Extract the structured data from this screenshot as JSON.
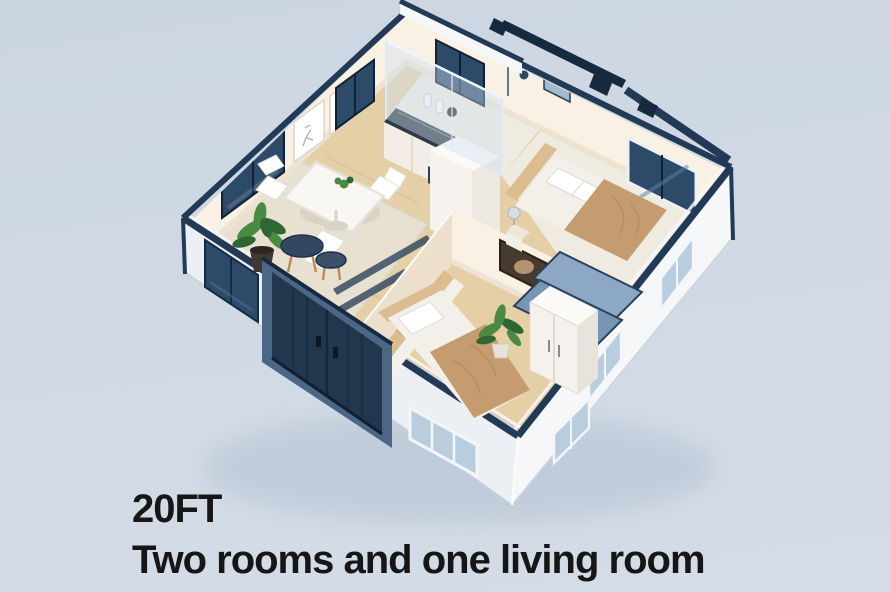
{
  "caption": {
    "line1": "20FT",
    "line2": "Two rooms and one living room"
  },
  "scene": {
    "type": "3d-isometric-cutaway-render",
    "subject": "20FT expandable container house, top-down isometric view with roof removed",
    "rooms": [
      {
        "name": "living-dining-room",
        "items": [
          "dining-table",
          "dining-chairs",
          "area-rug",
          "potted-plant",
          "round-coffee-tables",
          "wall-picture-frames",
          "windows"
        ]
      },
      {
        "name": "kitchen",
        "items": [
          "dark-stone-counter",
          "white-cabinets",
          "oven",
          "canisters",
          "window"
        ]
      },
      {
        "name": "bathroom",
        "items": [
          "glass-shower-enclosure",
          "shower-head",
          "vent-window"
        ]
      },
      {
        "name": "bedroom-right",
        "items": [
          "double-bed",
          "tan-blanket",
          "pillows",
          "headboard-cushions",
          "nightstand",
          "table-lamp",
          "window"
        ]
      },
      {
        "name": "bedroom-front",
        "items": [
          "double-bed",
          "tan-blanket",
          "bench-seat",
          "wardrobe",
          "potted-plant",
          "wall-art",
          "fold-out-roof-panels"
        ]
      }
    ],
    "exterior": [
      "navy-roof-trim",
      "roof-beams",
      "navy-double-entry-door",
      "navy-window",
      "pale-blue-windows",
      "white-siding"
    ]
  },
  "colors": {
    "bg_top": "#ccd6e2",
    "bg_bottom": "#d4dce7",
    "text": "#161616",
    "navy": "#223a55",
    "navy_deep": "#17293e",
    "frame_blue": "#4c6685",
    "glass_dark": "#2d4a69",
    "glass_streak": "#5d80a4",
    "wall_ext_light": "#f5f7f9",
    "wall_ext_shade": "#eceff3",
    "wall_int": "#f8f1e4",
    "wall_int_shade": "#ece0cd",
    "floor_wood": "#e5cfa7",
    "floor_wood_dark": "#d3b78c",
    "floor_pale": "#f0ebe1",
    "rug": "#e8e0d0",
    "glass_blue": "#cfe1f1",
    "panel_blue": "#8ca8c5",
    "panel_blue_dark": "#7795b5",
    "window_pale": "#b9cdde",
    "linen": "#f3f0e9",
    "blanket": "#c59c6f",
    "cushion": "#dcbd92",
    "counter_dark": "#2e3944",
    "plant": "#4a8a42",
    "plant_dark": "#2f6733",
    "table_dark": "#344760",
    "shadow": "#97a8bd"
  }
}
